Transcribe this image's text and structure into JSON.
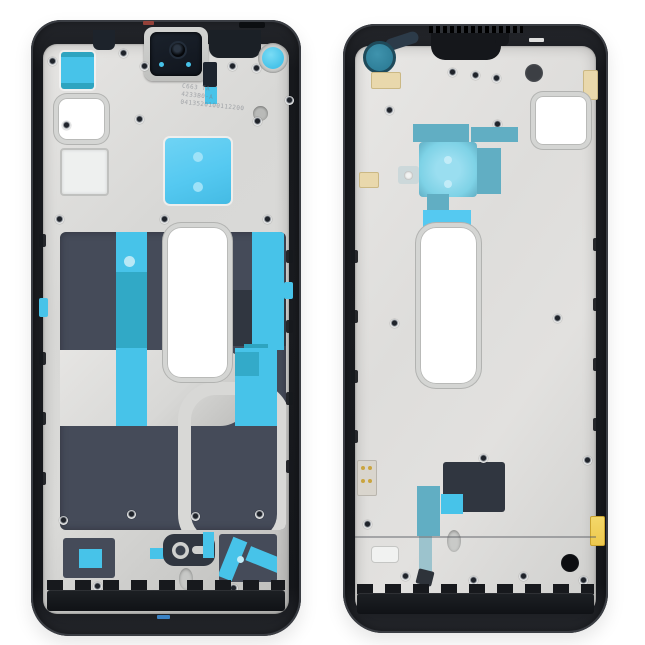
{
  "colors": {
    "background": "#ffffff",
    "frame_black": "#17191d",
    "frame_rim": "#45484f",
    "plate": "#d8d8d6",
    "plate_bright": "#e6e5e3",
    "plate_deep": "#bdbdbb",
    "graphite": "#454b59",
    "graphite_dark": "#303640",
    "cyan": "#47c3e9",
    "cyan_bright": "#55c9f1",
    "teal": "#2ea4c0",
    "teal_soft": "#61aec3",
    "teal_pale": "#7ed2e6",
    "punch_teal": "#2f7f99",
    "slate_dark": "#2c3b49",
    "cream": "#e9d8ac",
    "gold": "#edc84e",
    "red_mark": "#a8473c",
    "blue_dash": "#3b82c4"
  },
  "left_frame": {
    "engraving": {
      "line1": "C663 TA",
      "line2": "4233B0-A",
      "line3": "0413520100112200"
    }
  }
}
